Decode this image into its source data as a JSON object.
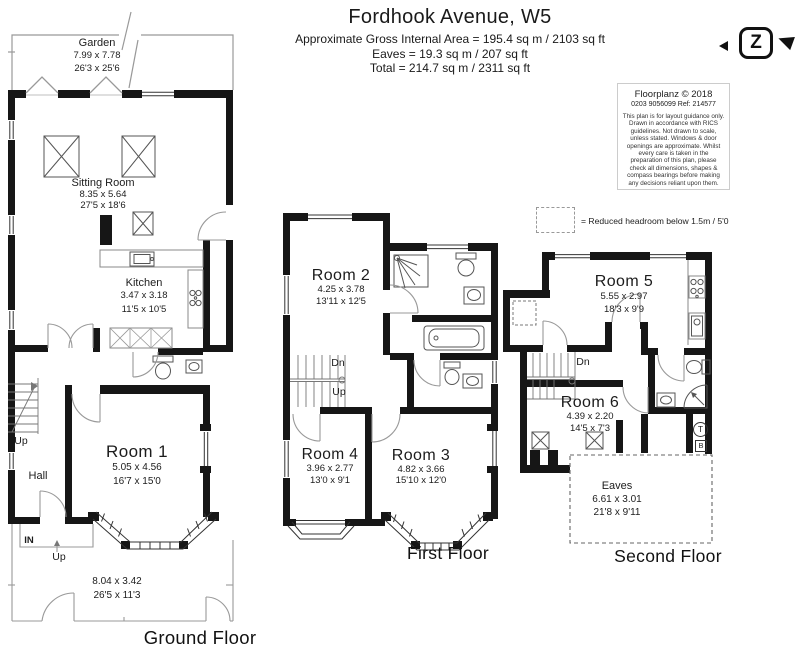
{
  "header": {
    "title": "Fordhook Avenue, W5",
    "line1": "Approximate Gross Internal Area = 195.4 sq m / 2103 sq ft",
    "line2": "Eaves = 19.3 sq m / 207 sq ft",
    "line3": "Total = 214.7 sq m / 2311 sq ft"
  },
  "logo": {
    "letter": "Z"
  },
  "info_box": {
    "company": "Floorplanz © 2018",
    "phone_ref": "0203 9056099 Ref: 214577",
    "disclaimer": "This plan is for layout guidance only. Drawn in accordance with RICS guidelines. Not drawn to scale, unless stated. Windows & door openings are approximate. Whilst every care is taken in the preparation of this plan, please check all dimensions, shapes & compass bearings before making any decisions reliant upon them."
  },
  "legend": {
    "reduced_headroom": "= Reduced headroom below 1.5m / 5'0"
  },
  "floors": {
    "ground": "Ground Floor",
    "first": "First Floor",
    "second": "Second Floor"
  },
  "rooms": {
    "garden": {
      "name": "Garden",
      "metric": "7.99 x 7.78",
      "imperial": "26'3 x 25'6"
    },
    "sitting_room": {
      "name": "Sitting Room",
      "metric": "8.35 x 5.64",
      "imperial": "27'5 x 18'6"
    },
    "kitchen": {
      "name": "Kitchen",
      "metric": "3.47 x 3.18",
      "imperial": "11'5 x 10'5"
    },
    "room1": {
      "name": "Room 1",
      "metric": "5.05 x 4.56",
      "imperial": "16'7 x 15'0"
    },
    "hall": {
      "name": "Hall"
    },
    "front_garden": {
      "metric": "8.04 x 3.42",
      "imperial": "26'5 x 11'3"
    },
    "room2": {
      "name": "Room 2",
      "metric": "4.25 x 3.78",
      "imperial": "13'11 x 12'5"
    },
    "room3": {
      "name": "Room 3",
      "metric": "4.82 x 3.66",
      "imperial": "15'10 x 12'0"
    },
    "room4": {
      "name": "Room 4",
      "metric": "3.96 x 2.77",
      "imperial": "13'0 x 9'1"
    },
    "room5": {
      "name": "Room 5",
      "metric": "5.55 x 2.97",
      "imperial": "18'3 x 9'9"
    },
    "room6": {
      "name": "Room 6",
      "metric": "4.39 x 2.20",
      "imperial": "14'5 x 7'3"
    },
    "eaves": {
      "name": "Eaves",
      "metric": "6.61 x 3.01",
      "imperial": "21'8 x 9'11"
    }
  },
  "annotations": {
    "up": "Up",
    "down": "Dn",
    "entrance": "IN",
    "t_symbol": "T",
    "b_symbol": "B"
  },
  "colors": {
    "wall": "#161616",
    "fixture_line": "#555555",
    "thin_line": "#999999"
  }
}
